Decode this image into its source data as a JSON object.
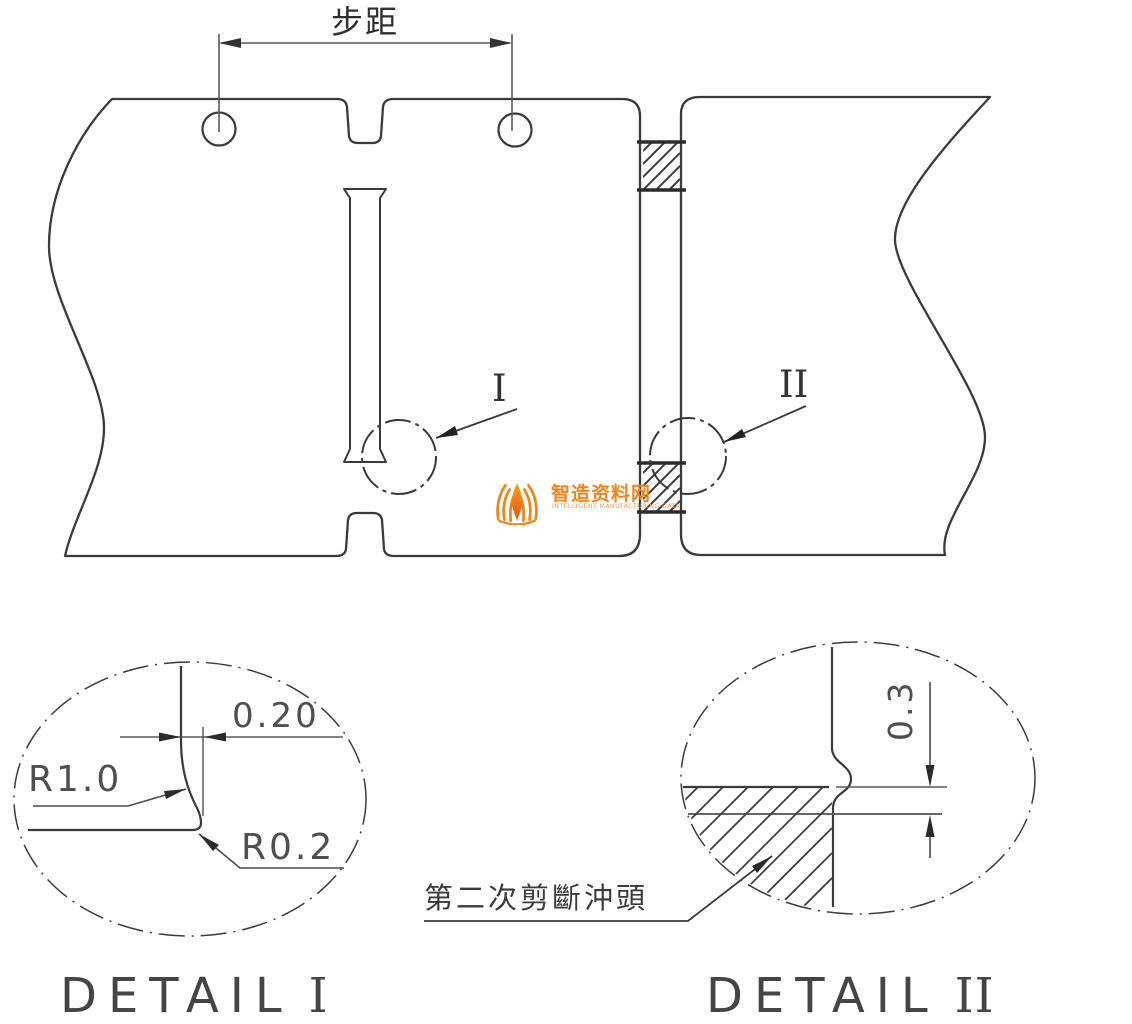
{
  "drawing": {
    "pitch_label": "步距",
    "markers": {
      "one": "I",
      "two": "II"
    },
    "detail_1": {
      "title_word": "DETAIL",
      "title_numeral": "I",
      "dim_gap": "0.20",
      "dim_radius_large": "R1.0",
      "dim_radius_small": "R0.2"
    },
    "detail_2": {
      "title_word": "DETAIL",
      "title_numeral": "II",
      "dim_depth": "0.3",
      "callout_label": "第二次剪斷沖頭"
    },
    "watermark": {
      "name": "智造资料网",
      "tagline": "INTELLIGENT MANUFACTURING DATA",
      "orange": "#F0851C"
    },
    "colors": {
      "line": "#3a3a3a",
      "dim_line": "#5a5a5a",
      "text": "#4f4f4f"
    }
  }
}
